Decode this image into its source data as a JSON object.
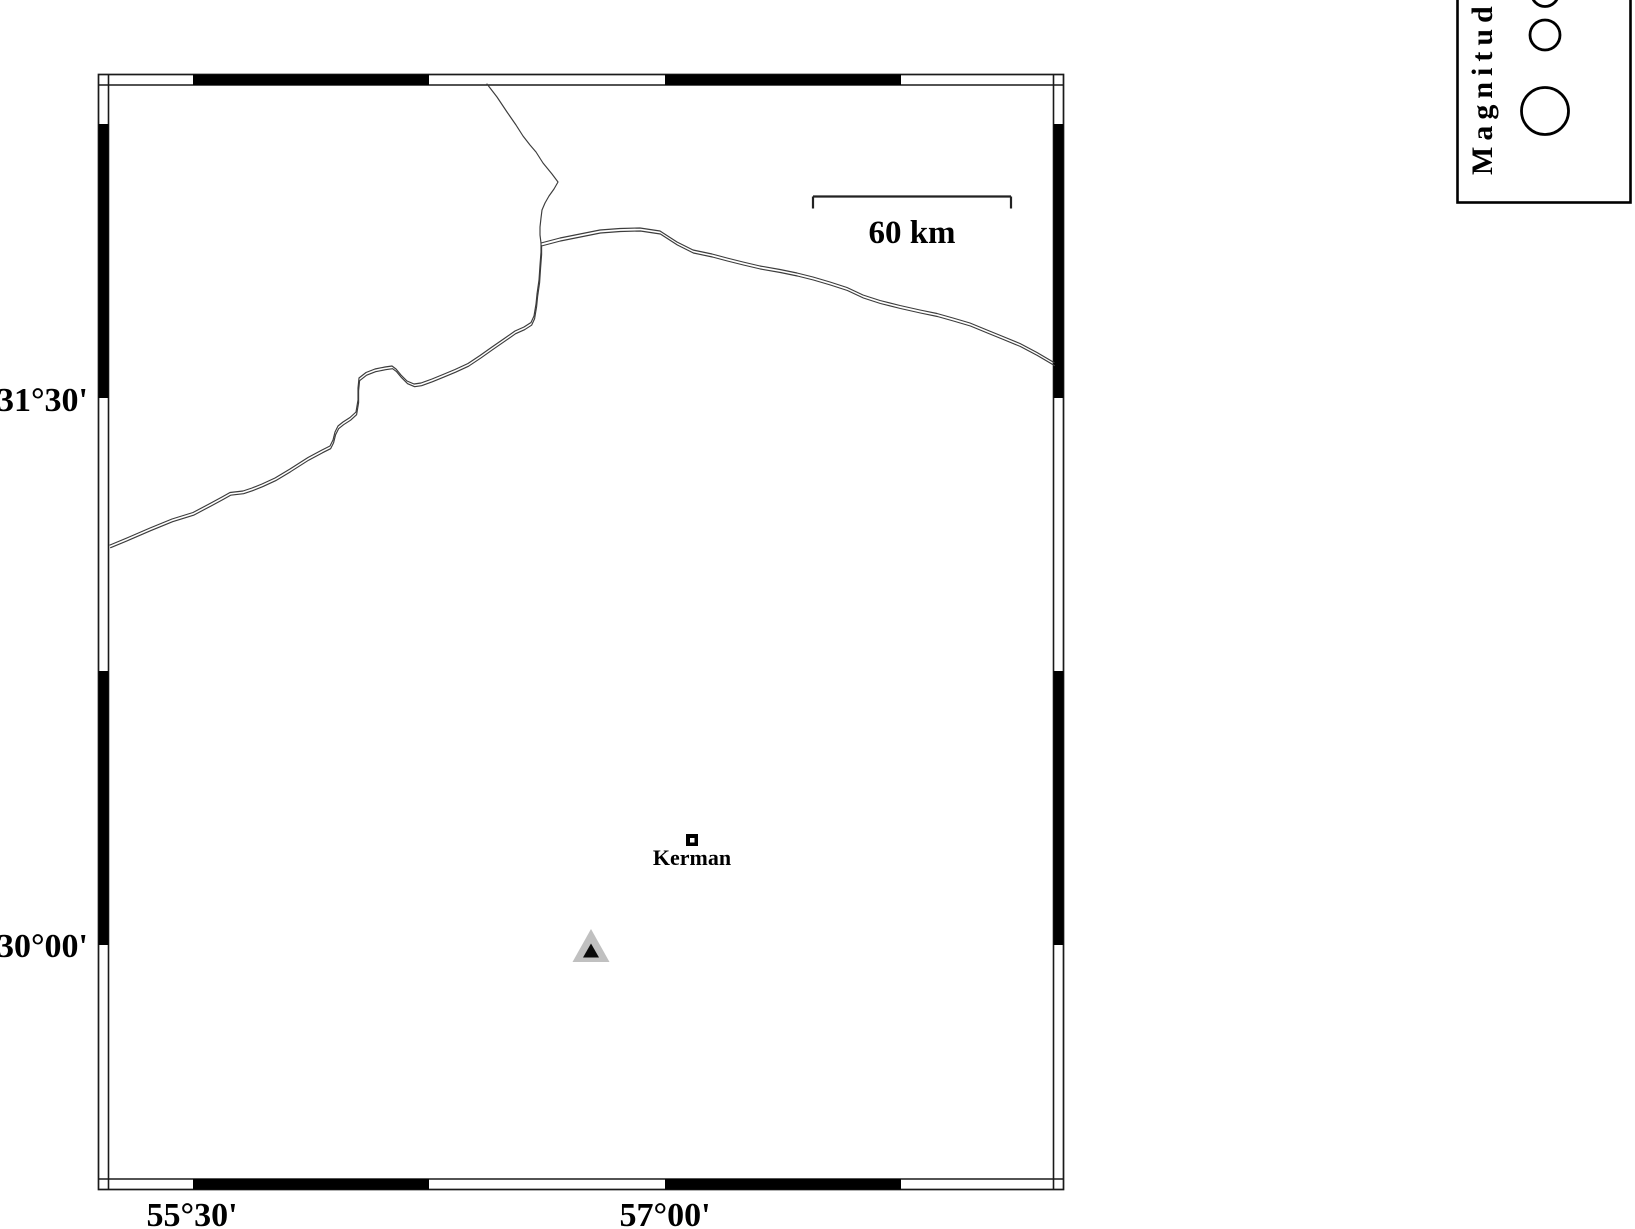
{
  "colors": {
    "background": "#ffffff",
    "frame": "#1a1a1a",
    "road": "#3c3c3c",
    "station_gray": "#c0c0c0",
    "station_black": "#0a0a0a",
    "ink": "#000000"
  },
  "frame": {
    "lat_ticks": [
      {
        "label": "31°30'"
      },
      {
        "label": "30°00'"
      }
    ],
    "lon_ticks": [
      {
        "label": "55°30'"
      },
      {
        "label": "57°00'"
      }
    ]
  },
  "scale_bar": {
    "label": "60 km"
  },
  "city": {
    "label": "Kerman"
  },
  "legend": {
    "title": "Magnitude",
    "circles": [
      {
        "size": "small",
        "r": 13.5
      },
      {
        "size": "medium",
        "r": 15
      },
      {
        "size": "large",
        "r": 23.5
      }
    ]
  },
  "map_data": {
    "roads": [
      {
        "id": "north-road",
        "style": "single",
        "path": "M 487,84 L 497,97 507,112 516,125 523,136 530,145 536,152 543,163 552,174 558,182 554,189 549,196 545,203 542,210 541,218 540,227 540,235 541,243"
      },
      {
        "id": "west-road",
        "style": "double",
        "path": "M 110,545 L 128,537.5 150,528 172,519 193,512.5 210,503.5 222,497 230,492.5 243,491 252,488 262,484 275,478 290,469 308,457.5 322,450 330,446 333,440 335,432 338,426 343,422 350,417.5 356,412 358,400 358,388 359,378 366,372.5 375,369 385,367 392,366 396,369 401,375 407,381 414,384 421,383 432,379 443,374.5 455,369.5 468,363.5 480,355.5 492,347 505,338 515,331 524,327 531,322.5 534,316 536,304 537,294 539,280 540,265 541,252 541,243"
      },
      {
        "id": "east-road",
        "style": "double",
        "path": "M 541,243 L 560,238 580,234 600,230 620,228.5 640,228 660,231 677,242 693,250 712,254 727,258 743,262 760,266 780,269.5 797,273 813,277 830,282 847,287.5 863,295 880,300.5 900,305.5 920,310 937,313.5 953,318 970,323 987,330 1003,336.5 1020,343.5 1037,352.5 1054,362.5"
      }
    ]
  }
}
